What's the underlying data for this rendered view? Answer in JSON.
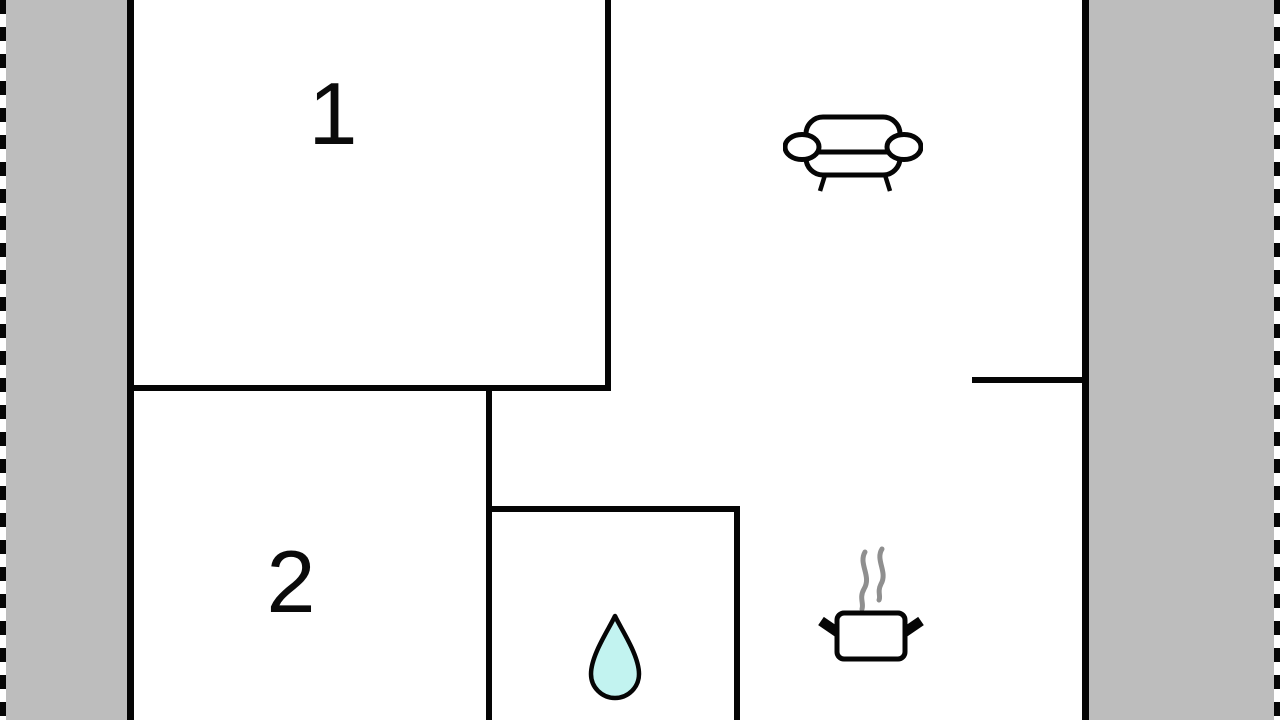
{
  "floorplan": {
    "kind": "floor-plan",
    "rooms": [
      {
        "name": "room-1",
        "label": "1"
      },
      {
        "name": "room-2",
        "label": "2"
      }
    ],
    "icons": [
      {
        "name": "sofa-icon",
        "area": "living-area"
      },
      {
        "name": "water-drop-icon",
        "area": "bathroom"
      },
      {
        "name": "cooking-pot-icon",
        "area": "kitchen"
      }
    ],
    "colors": {
      "wall": "#050505",
      "terrace_fill": "#bdbdbd",
      "water_drop_fill": "#c2f3f0",
      "steam_gray": "#8f8f8f",
      "background": "#ffffff"
    }
  }
}
